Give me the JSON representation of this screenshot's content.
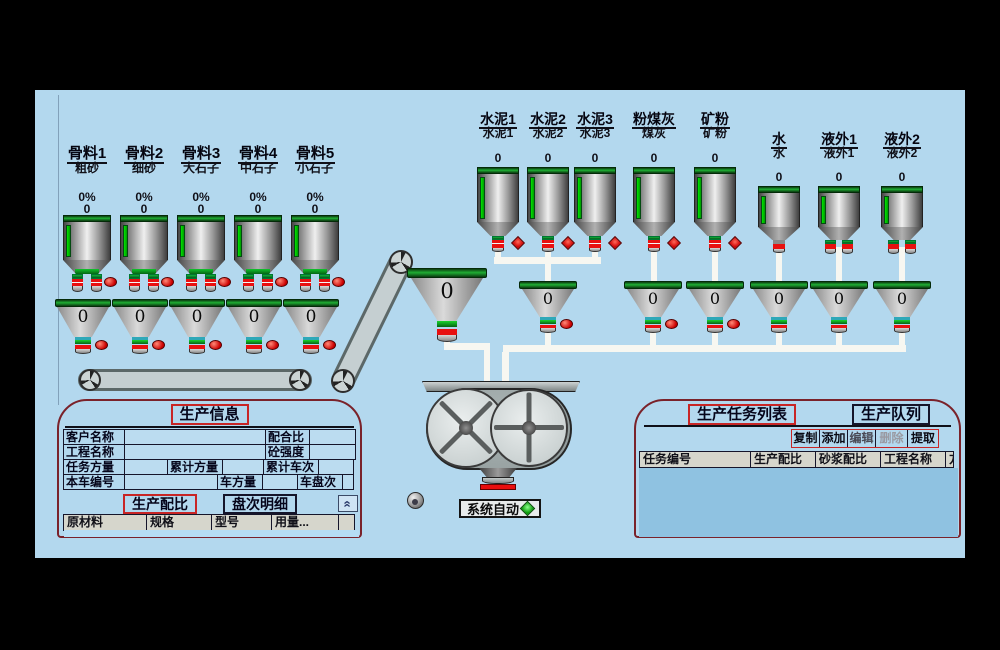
{
  "colors": {
    "background": "#b3d8ee",
    "panel_border": "#7a222a",
    "accent_red": "#c82525",
    "indicator_red": "#cc0000",
    "level_green": "#00c000"
  },
  "aggregates": [
    {
      "name": "骨料1",
      "material": "粗砂",
      "percent": "0%",
      "weight": "0",
      "hopper_value": "0"
    },
    {
      "name": "骨料2",
      "material": "细砂",
      "percent": "0%",
      "weight": "0",
      "hopper_value": "0"
    },
    {
      "name": "骨料3",
      "material": "大石子",
      "percent": "0%",
      "weight": "0",
      "hopper_value": "0"
    },
    {
      "name": "骨料4",
      "material": "中石子",
      "percent": "0%",
      "weight": "0",
      "hopper_value": "0"
    },
    {
      "name": "骨料5",
      "material": "小石子",
      "percent": "0%",
      "weight": "0",
      "hopper_value": "0"
    }
  ],
  "powders": [
    {
      "name": "水泥1",
      "material": "水泥1",
      "value": "0"
    },
    {
      "name": "水泥2",
      "material": "水泥2",
      "value": "0"
    },
    {
      "name": "水泥3",
      "material": "水泥3",
      "value": "0"
    },
    {
      "name": "粉煤灰",
      "material": "煤灰",
      "value": "0"
    },
    {
      "name": "矿粉",
      "material": "矿粉",
      "value": "0"
    }
  ],
  "liquids": [
    {
      "name": "水",
      "material": "水",
      "value": "0"
    },
    {
      "name": "液外1",
      "material": "液外1",
      "value": "0"
    },
    {
      "name": "液外2",
      "material": "液外2",
      "value": "0"
    }
  ],
  "right_hoppers": {
    "values": [
      "0",
      "0",
      "0",
      "0",
      "0",
      "0"
    ]
  },
  "transfer_hopper": {
    "value": "0"
  },
  "status": {
    "label": "系统自动"
  },
  "info_panel": {
    "title": "生产信息",
    "fields": {
      "customer": "客户名称",
      "mix_ratio": "配合比",
      "project": "工程名称",
      "strength": "砼强度",
      "task_volume": "任务方量",
      "total_volume": "累计方量",
      "total_trucks": "累计车次",
      "truck_no": "本车编号",
      "truck_volume": "车方量",
      "batch_no": "车盘次"
    },
    "tabs": [
      "生产配比",
      "盘次明细"
    ],
    "collapse": "«",
    "table_headers": [
      "原材料",
      "规格",
      "型号",
      "用量...",
      ""
    ]
  },
  "task_panel": {
    "tabs": [
      "生产任务列表",
      "生产队列"
    ],
    "buttons": [
      "复制",
      "添加",
      "编辑",
      "删除",
      "提取"
    ],
    "table_headers": [
      "任务编号",
      "生产配比",
      "砂浆配比",
      "工程名称",
      "方"
    ]
  }
}
